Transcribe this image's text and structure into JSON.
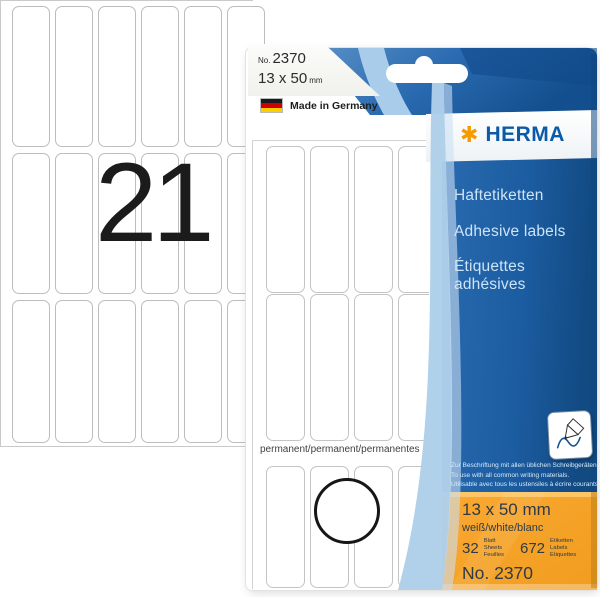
{
  "colors": {
    "brand_blue": "#0a5aa8",
    "brand_orange": "#f59b00",
    "panel_blue": "#1b5b9f",
    "panel_orange": "#f9a62c",
    "sweep_light_blue": "#aecfea"
  },
  "sheet": {
    "big_number": "21",
    "columns": 6,
    "rows": 3
  },
  "package": {
    "tag": {
      "no_prefix": "No.",
      "article_number": "2370",
      "size": "13 x 50",
      "unit": "mm"
    },
    "origin": "Made in Germany",
    "brand": "HERMA",
    "star": "✱",
    "names": {
      "de": "Haftetiketten",
      "en": "Adhesive labels",
      "fr_line1": "Étiquettes",
      "fr_line2": "adhésives"
    },
    "print_sheet": {
      "columns": 4,
      "rows": 3,
      "permanent": "permanent/permanent/permanentes"
    },
    "usage": {
      "de": "Zur Beschriftung mit allen üblichen Schreibgeräten.",
      "en": "To use with all common writing materials.",
      "fr": "Utilisable avec tous les ustensiles à écrire courants."
    },
    "spec": {
      "size": "13 x 50 mm",
      "color_names": "weiß/white/blanc",
      "sheets_value": "32",
      "sheets_units": [
        "Blatt",
        "Sheets",
        "Feuilles"
      ],
      "labels_value": "672",
      "labels_units": [
        "Etiketten",
        "Labels",
        "Etiquettes"
      ],
      "article": "No. 2370"
    }
  }
}
